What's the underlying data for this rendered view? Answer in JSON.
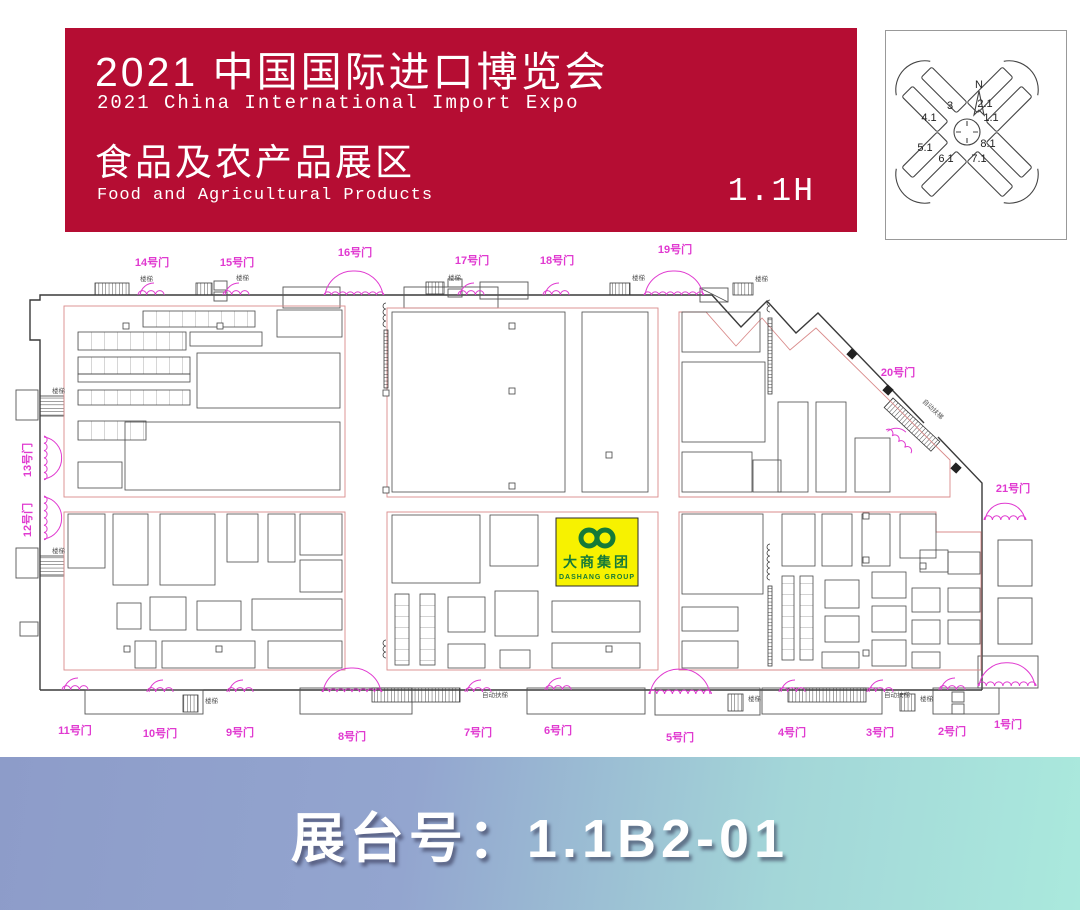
{
  "header": {
    "title_cn": "2021 中国国际进口博览会",
    "title_en": "2021 China International Import Expo",
    "subtitle_cn": "食品及农产品展区",
    "subtitle_en": "Food and Agricultural Products",
    "hall": "1.1H"
  },
  "overview_map": {
    "north": "N",
    "halls": [
      "3",
      "2.1",
      "4.1",
      "1.1",
      "5.1",
      "8.1",
      "6.1",
      "7.1"
    ]
  },
  "floorplan": {
    "highlight_booth": {
      "name_cn": "大商集团",
      "name_en": "DASHANG GROUP"
    },
    "gates": [
      {
        "label": "14号门",
        "lx": 152,
        "ly": 266,
        "sx": 138,
        "sy": 295,
        "w": 26,
        "rot": 0
      },
      {
        "label": "15号门",
        "lx": 237,
        "ly": 266,
        "sx": 223,
        "sy": 295,
        "w": 26,
        "rot": 0
      },
      {
        "label": "16号门",
        "lx": 355,
        "ly": 256,
        "sx": 324,
        "sy": 295,
        "w": 60,
        "rot": 0
      },
      {
        "label": "17号门",
        "lx": 472,
        "ly": 264,
        "sx": 458,
        "sy": 295,
        "w": 26,
        "rot": 0
      },
      {
        "label": "18号门",
        "lx": 557,
        "ly": 264,
        "sx": 543,
        "sy": 295,
        "w": 26,
        "rot": 0
      },
      {
        "label": "19号门",
        "lx": 675,
        "ly": 253,
        "sx": 644,
        "sy": 295,
        "w": 60,
        "rot": 0
      },
      {
        "label": "20号门",
        "lx": 898,
        "ly": 376,
        "sx": 886,
        "sy": 430,
        "w": 34,
        "rot": 43
      },
      {
        "label": "21号门",
        "lx": 1013,
        "ly": 492,
        "sx": 984,
        "sy": 520,
        "w": 42,
        "rot": 0
      },
      {
        "label": "13号门",
        "lx": 31,
        "ly": 460,
        "sx": 44,
        "sy": 436,
        "w": 44,
        "rot": 90,
        "vert": true
      },
      {
        "label": "12号门",
        "lx": 31,
        "ly": 520,
        "sx": 44,
        "sy": 496,
        "w": 44,
        "rot": 90,
        "vert": true
      },
      {
        "label": "11号门",
        "lx": 75,
        "ly": 734,
        "sx": 62,
        "sy": 690,
        "w": 26,
        "rot": 0
      },
      {
        "label": "10号门",
        "lx": 160,
        "ly": 737,
        "sx": 147,
        "sy": 692,
        "w": 26,
        "rot": 0
      },
      {
        "label": "9号门",
        "lx": 240,
        "ly": 736,
        "sx": 227,
        "sy": 692,
        "w": 26,
        "rot": 0
      },
      {
        "label": "8号门",
        "lx": 352,
        "ly": 740,
        "sx": 322,
        "sy": 692,
        "w": 60,
        "rot": 0
      },
      {
        "label": "7号门",
        "lx": 478,
        "ly": 736,
        "sx": 465,
        "sy": 692,
        "w": 26,
        "rot": 0
      },
      {
        "label": "6号门",
        "lx": 558,
        "ly": 734,
        "sx": 545,
        "sy": 690,
        "w": 26,
        "rot": 0
      },
      {
        "label": "5号门",
        "lx": 680,
        "ly": 741,
        "sx": 649,
        "sy": 694,
        "w": 62,
        "rot": 0
      },
      {
        "label": "4号门",
        "lx": 792,
        "ly": 736,
        "sx": 779,
        "sy": 692,
        "w": 26,
        "rot": 0
      },
      {
        "label": "3号门",
        "lx": 880,
        "ly": 736,
        "sx": 867,
        "sy": 692,
        "w": 26,
        "rot": 0
      },
      {
        "label": "2号门",
        "lx": 952,
        "ly": 735,
        "sx": 939,
        "sy": 690,
        "w": 26,
        "rot": 0
      },
      {
        "label": "1号门",
        "lx": 1008,
        "ly": 728,
        "sx": 978,
        "sy": 686,
        "w": 58,
        "rot": 0
      }
    ],
    "facility_labels": [
      {
        "text": "楼梯",
        "x": 140,
        "y": 281
      },
      {
        "text": "楼梯",
        "x": 236,
        "y": 280
      },
      {
        "text": "楼梯",
        "x": 448,
        "y": 280
      },
      {
        "text": "楼梯",
        "x": 632,
        "y": 280
      },
      {
        "text": "楼梯",
        "x": 755,
        "y": 281
      },
      {
        "text": "楼梯",
        "x": 52,
        "y": 393
      },
      {
        "text": "楼梯",
        "x": 52,
        "y": 553
      },
      {
        "text": "楼梯",
        "x": 205,
        "y": 703
      },
      {
        "text": "楼梯",
        "x": 748,
        "y": 701
      },
      {
        "text": "楼梯",
        "x": 920,
        "y": 701
      },
      {
        "text": "自动扶梯",
        "x": 482,
        "y": 697
      },
      {
        "text": "自动扶梯",
        "x": 884,
        "y": 697
      },
      {
        "text": "自动扶梯",
        "x": 922,
        "y": 402,
        "rot": 43
      }
    ]
  },
  "footer": {
    "booth_label": "展台号：1.1B2-01"
  },
  "colors": {
    "banner_red": "#b50d33",
    "gate_magenta": "#e03ad0",
    "boundary_red": "#d98b8b",
    "booth_yellow": "#f7f200",
    "logo_green": "#157a38",
    "footer_left": "#8d9cc9",
    "footer_right": "#aae9dd"
  }
}
